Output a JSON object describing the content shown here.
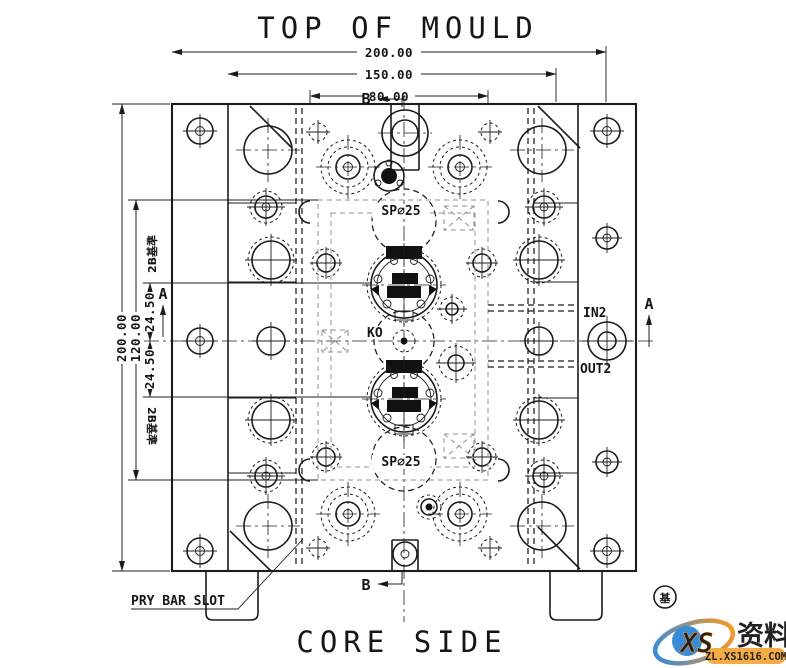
{
  "titles": {
    "top": "TOP OF MOULD",
    "bottom": "CORE SIDE"
  },
  "dimensions": {
    "top_width": "200.00",
    "mid_width": "150.00",
    "pocket_width": "80.00",
    "left_height": "200.00",
    "inner_height": "120.00",
    "offset_upper": "24.50",
    "offset_lower": "24.50"
  },
  "labels": {
    "spring_top": "SP∅25",
    "spring_bottom": "SP∅25",
    "knockout": "KO",
    "water_in": "IN2",
    "water_out": "OUT2",
    "pry_bar": "PRY BAR SLOT",
    "datum_note_upper": "2B基準",
    "datum_note_lower": "2B基準",
    "section_a": "A",
    "section_b": "B"
  },
  "watermark": {
    "logo": "XS",
    "site_name": "资料网",
    "site_url": "ZL.XS1616.COM",
    "stamp": "基"
  },
  "colors": {
    "line": "#1c1c1c",
    "wm_orange": "#ed6c1e",
    "wm_blue": "#2e86d4",
    "wm_band": "#f5a73b"
  }
}
